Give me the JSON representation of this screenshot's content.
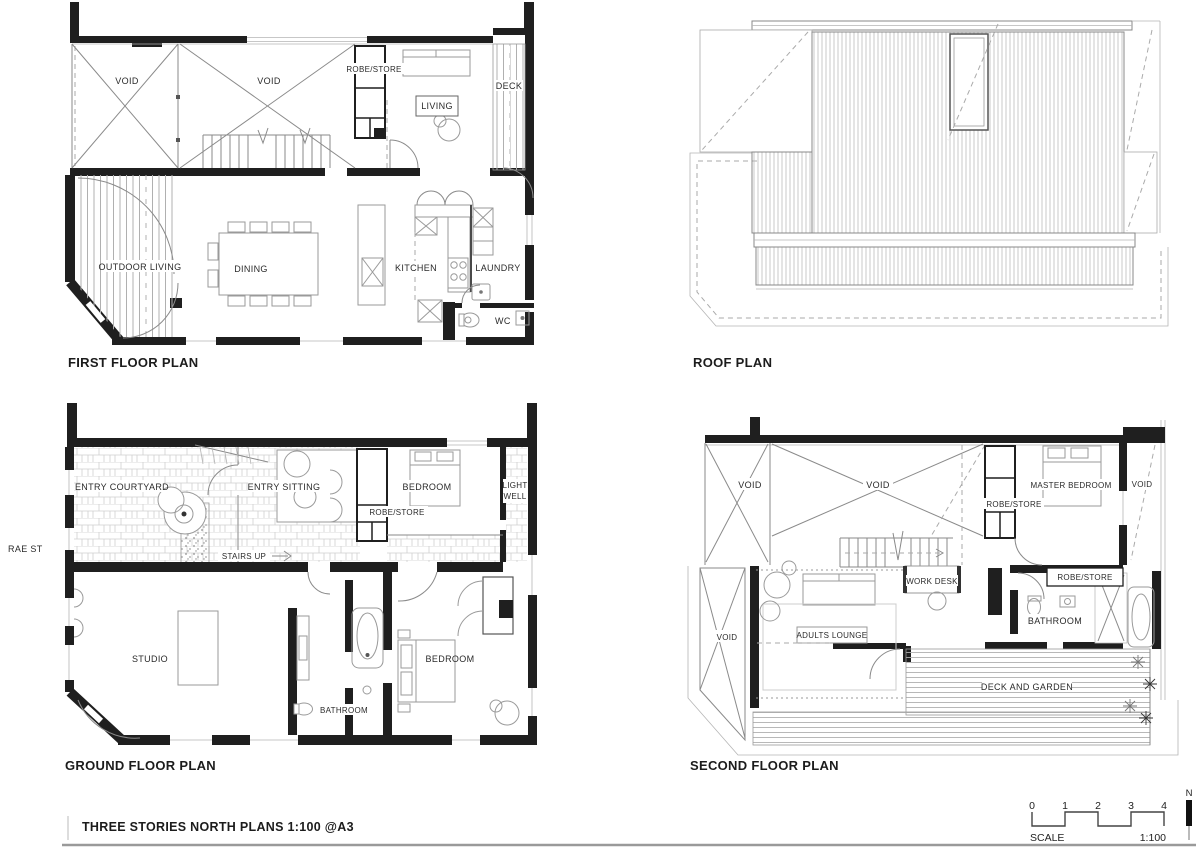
{
  "plans": {
    "first_floor": {
      "title": "FIRST FLOOR PLAN",
      "labels": {
        "void_left": "VOID",
        "void_center": "VOID",
        "robe_store": "ROBE/STORE",
        "living": "LIVING",
        "deck": "DECK",
        "outdoor_living": "OUTDOOR LIVING",
        "dining": "DINING",
        "kitchen": "KITCHEN",
        "laundry": "LAUNDRY",
        "wc": "WC"
      }
    },
    "roof": {
      "title": "ROOF PLAN"
    },
    "ground_floor": {
      "title": "GROUND FLOOR PLAN",
      "street": "RAE ST",
      "labels": {
        "entry_courtyard": "ENTRY COURTYARD",
        "entry_sitting": "ENTRY SITTING",
        "robe_store": "ROBE/STORE",
        "bedroom_front": "BEDROOM",
        "light_well_line1": "LIGHT",
        "light_well_line2": "WELL",
        "stairs_up": "STAIRS UP",
        "studio": "STUDIO",
        "bathroom": "BATHROOM",
        "bedroom_rear": "BEDROOM"
      }
    },
    "second_floor": {
      "title": "SECOND FLOOR PLAN",
      "labels": {
        "void_left": "VOID",
        "void_center": "VOID",
        "robe_store_upper": "ROBE/STORE",
        "master_bedroom": "MASTER BEDROOM",
        "void_right": "VOID",
        "work_desk": "WORK DESK",
        "robe_store_lower": "ROBE/STORE",
        "void_lower": "VOID",
        "adults_lounge": "ADULTS LOUNGE",
        "bathroom": "BATHROOM",
        "deck_and_garden": "DECK AND GARDEN"
      }
    }
  },
  "footer": {
    "drawing_title": "THREE STORIES NORTH PLANS 1:100 @A3",
    "scale_label": "SCALE",
    "scale_ratio": "1:100",
    "scale_ticks": [
      "0",
      "1",
      "2",
      "3",
      "4"
    ],
    "north_label": "N"
  }
}
